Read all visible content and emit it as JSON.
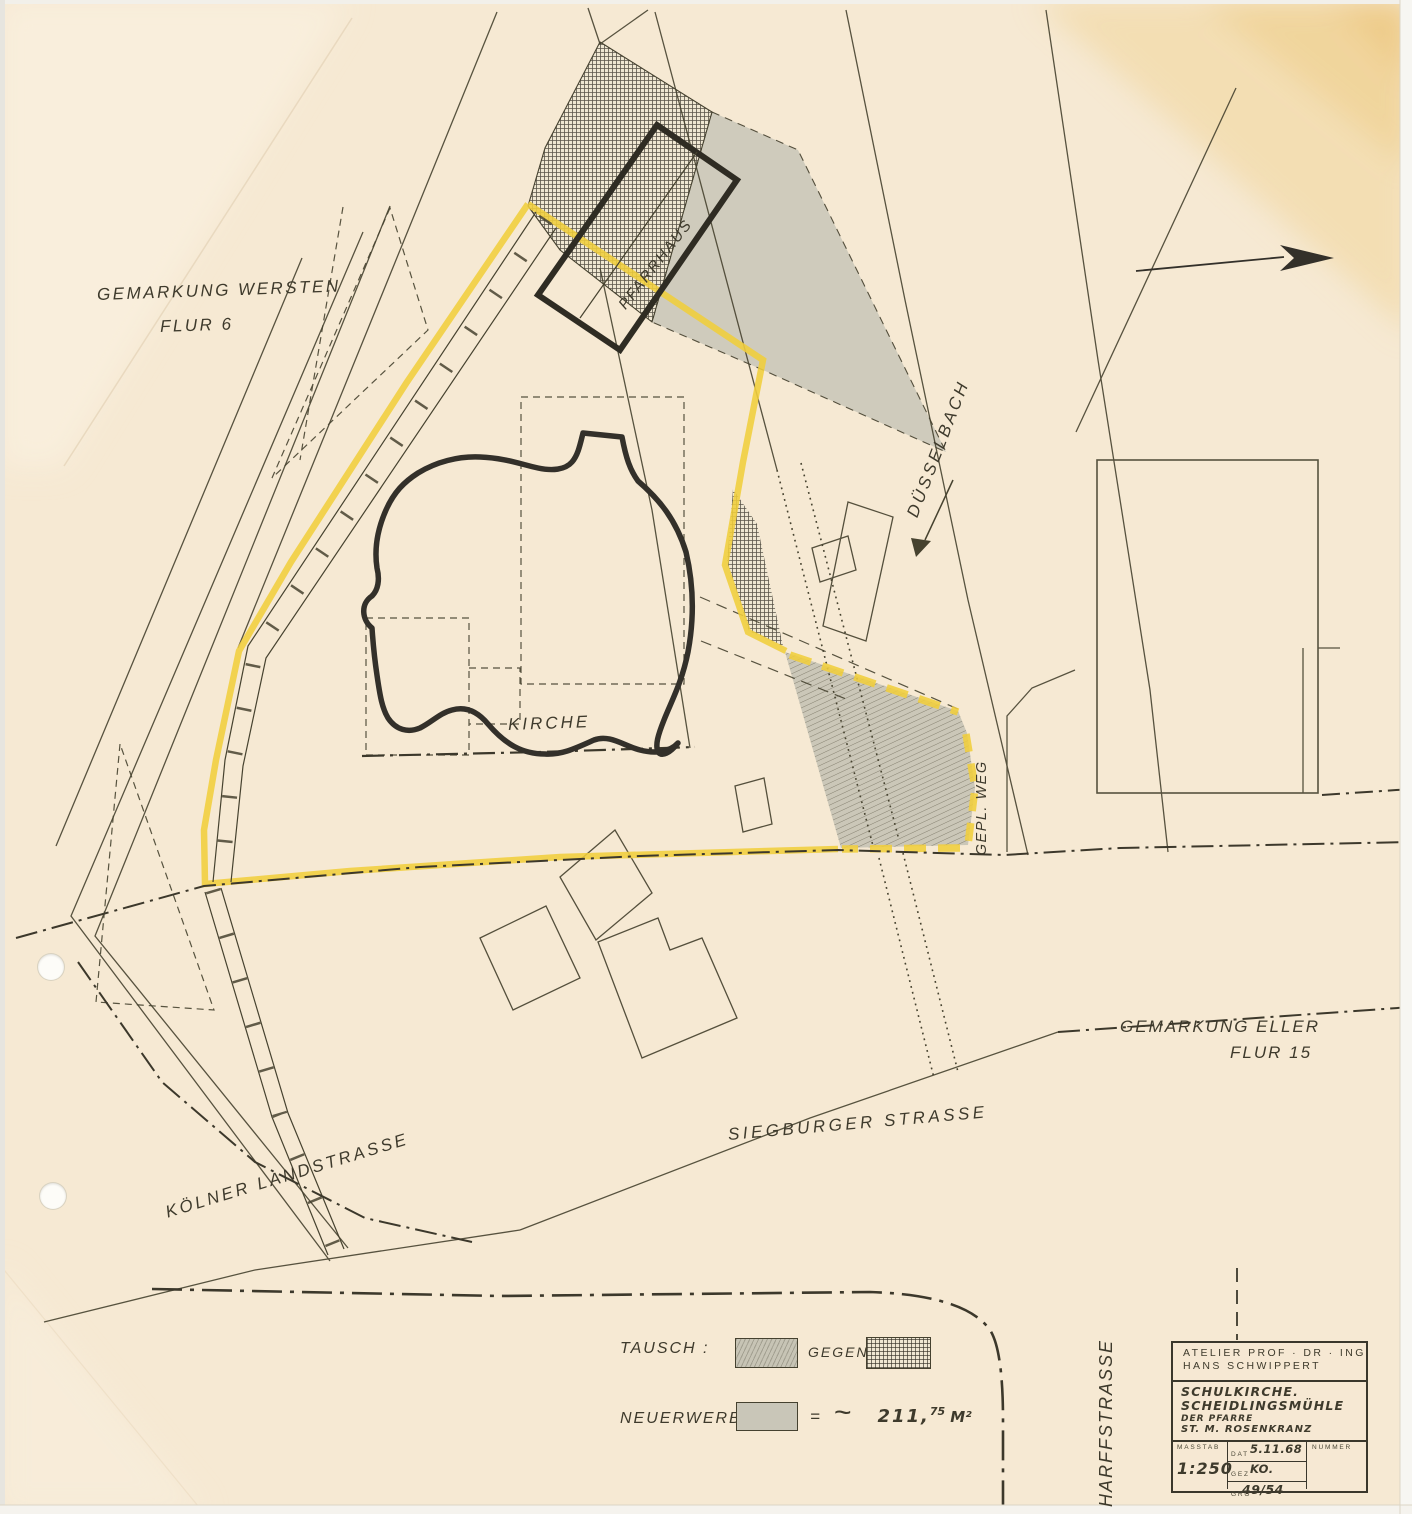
{
  "colors": {
    "paper": "#f6e9d3",
    "ink": "#3e3a2c",
    "highlight_yellow": "#f1ce3c",
    "area_gray": "#c9c6b8",
    "stain_amber": "#f0d29a"
  },
  "map_labels": {
    "gemarkung_wersten_line1": "GEMARKUNG WERSTEN",
    "gemarkung_wersten_line2": "FLUR 6",
    "pfarrhaus": "PFARRHAUS",
    "duesselbach": "DÜSSELBACH",
    "kirche": "KIRCHE",
    "gepl_weg": "GEPL. WEG",
    "gemarkung_eller_line1": "GEMARKUNG ELLER",
    "gemarkung_eller_line2": "FLUR 15",
    "siegburger_strasse": "SIEGBURGER STRASSE",
    "koelner_landstrasse": "KÖLNER LANDSTRASSE",
    "harffstrasse": "HARFFSTRASSE"
  },
  "legend": {
    "tausch_label": "TAUSCH :",
    "gegen_label": "GEGEN",
    "neuerwerb_label": "NEUERWERB:",
    "equals": "=",
    "approx_tilde": "~",
    "area_number": "211,",
    "area_exponent": "75",
    "area_unit": "M²"
  },
  "title_block": {
    "atelier_line1": "ATELIER PROF · DR · ING",
    "atelier_line2": "HANS SCHWIPPERT",
    "project_line1": "SCHULKIRCHE.",
    "project_line2": "SCHEIDLINGSMÜHLE",
    "project_line3": "DER PFARRE",
    "project_line4": "ST. M. ROSENKRANZ",
    "masstab_label": "MASSTAB",
    "masstab_value": "1:250",
    "dat_label": "DAT",
    "dat_value": "5.11.68",
    "gez_label": "GEZ",
    "gez_value": "KO.",
    "gro_label": "GRO",
    "gro_value": "49/54",
    "nummer_label": "NUMMER"
  }
}
